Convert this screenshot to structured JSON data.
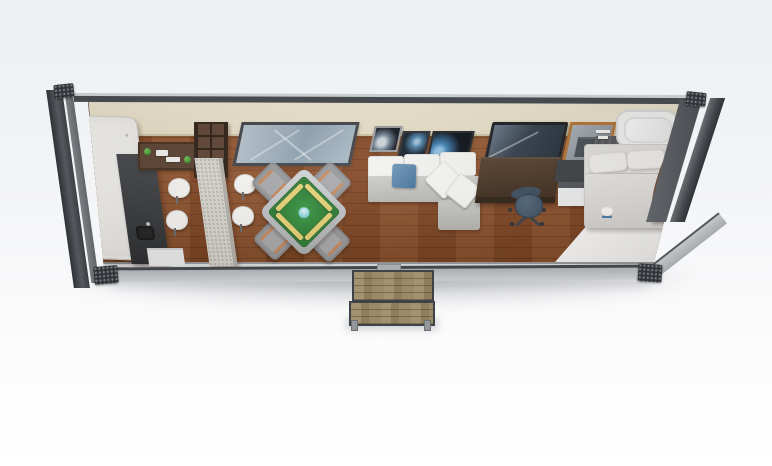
{
  "scene": {
    "type": "3d-render-top-down-floor-plan",
    "subject": "shipping container tiny home interior",
    "palette": {
      "background_top": "#edeff1",
      "background_bottom": "#ffffff",
      "frame_dark": "#46494e",
      "rail_light": "#c9ccce",
      "wall_cream": "#ebe4cd",
      "floor_wood": "#8a4e2a",
      "floor_white": "#fbfbfa",
      "mahjong_green": "#2f8438",
      "tile_rack_yellow": "#e8d175",
      "pillow_blue": "#4f7ca6",
      "sofa_grey": "#c9c9c5",
      "desk_brown": "#46362a",
      "office_chair_slate": "#46596b",
      "door_frame_orange": "#b5763a",
      "steps_wood": "#9c8c6c"
    },
    "objects": {
      "container": "shipping container shell with corner posts and castings",
      "wardrobe": "white storage cabinet at left end",
      "kitchen_counter": "dark kitchen counter with sink",
      "wall_shelf": "wall shelf with plants and dishes",
      "bookcase": "wooden shelving unit",
      "bar_counter": "stone breakfast bar",
      "bar_stool": "white dining stool",
      "window": "long wall window",
      "mahjong_table": "green mahjong table with tile racks",
      "game_chair": "grey game chair",
      "art_frame": "framed earth-from-space artwork",
      "sofa": "grey sectional sofa with white cushions and blue pillow",
      "tv": "flat screen tv",
      "desk": "dark wood work desk",
      "office_chair": "slate office chair",
      "mirror_door": "orange framed mirror doorway",
      "nightstand": "bedside cabinet",
      "partition": "bathroom partition wall",
      "bathtub": "white bathtub",
      "bed": "double bed with pillows",
      "headboard": "channel tufted headboard panel",
      "white_floor": "white bedroom floor section",
      "steps": "wooden entry steps"
    }
  }
}
